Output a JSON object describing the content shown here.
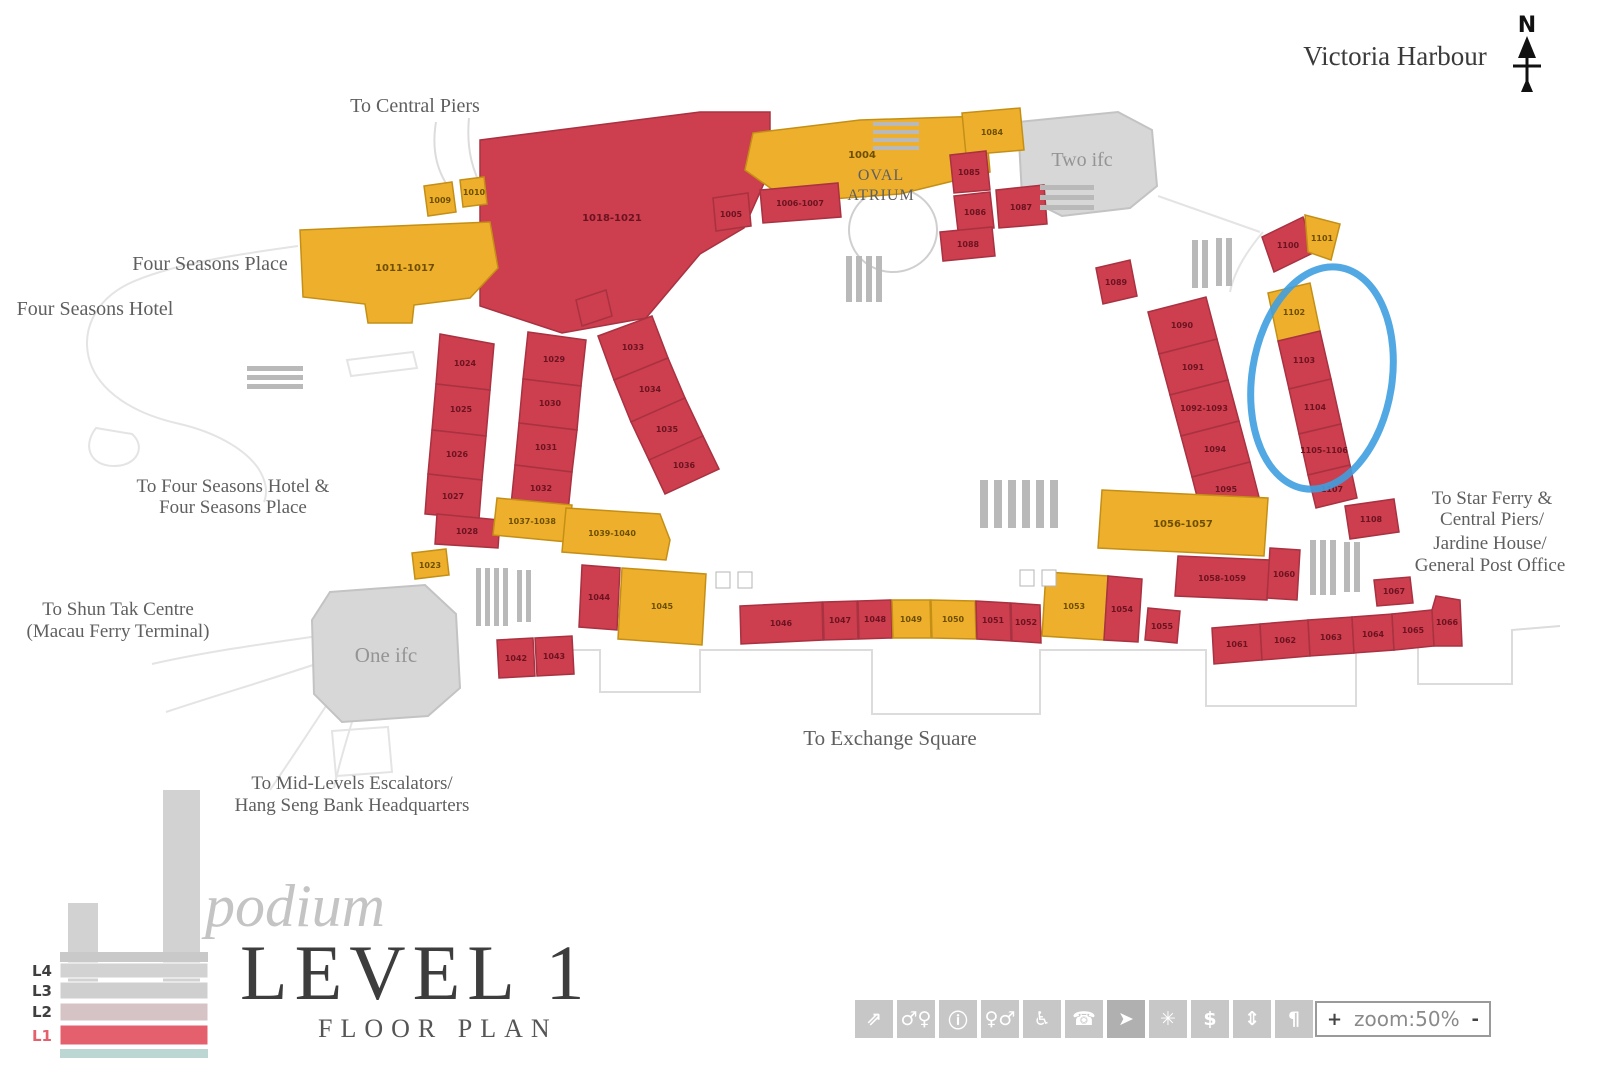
{
  "title": {
    "script": "podium",
    "main": "LEVEL 1",
    "sub": "FLOOR PLAN"
  },
  "labels": {
    "victoria_harbour": "Victoria Harbour",
    "to_central_piers": "To Central Piers",
    "four_seasons_place": "Four Seasons Place",
    "four_seasons_hotel": "Four Seasons Hotel",
    "to_four_seasons_1": "To Four Seasons Hotel &",
    "to_four_seasons_2": "Four Seasons Place",
    "to_shun_tak_1": "To Shun Tak Centre",
    "to_shun_tak_2": "(Macau Ferry Terminal)",
    "one_ifc": "One ifc",
    "two_ifc": "Two ifc",
    "oval_1": "OVAL",
    "oval_2": "ATRIUM",
    "to_exchange_square": "To Exchange Square",
    "to_mid_levels_1": "To Mid-Levels Escalators/",
    "to_mid_levels_2": "Hang Seng Bank Headquarters",
    "to_star_ferry_1": "To Star Ferry &",
    "to_star_ferry_2": "Central Piers/",
    "to_star_ferry_3": "Jardine House/",
    "to_star_ferry_4": "General Post Office",
    "compass_n": "N"
  },
  "levels": [
    {
      "label": "L4",
      "active": false
    },
    {
      "label": "L3",
      "active": false
    },
    {
      "label": "L2",
      "active": false
    },
    {
      "label": "L1",
      "active": true
    }
  ],
  "shops": {
    "tl_big": "1018-1021",
    "fsp": "1011-1017",
    "y_small1": "1009",
    "y_small2": "1010",
    "wedge": "1004",
    "under_a": "1005",
    "under_b": "1006-1007",
    "oval_y": "1084",
    "oval_r1": "1085",
    "oval_r2": "1086",
    "oval_r3": "1087",
    "oval_r4": "1088",
    "tr_red": "1100",
    "tr_yellow": "1101",
    "col_y": "1102",
    "col_r1": "1103",
    "col_r2": "1104",
    "col_r3": "1105-1106",
    "col_foot": "1107",
    "col_below": "1108",
    "rc_top": "1089",
    "rc1": "1090",
    "rc2": "1091",
    "rc3": "1092-1093",
    "rc4": "1094",
    "rc5": "1095",
    "la1": "1024",
    "la2": "1025",
    "la3": "1026",
    "la4": "1027",
    "la5": "1028",
    "lb1": "1029",
    "lb2": "1030",
    "lb3": "1031",
    "lb4": "1032",
    "arc1": "1033",
    "arc2": "1034",
    "arc3": "1035",
    "arc4": "1036",
    "ym1": "1037-1038",
    "ym2": "1039-1040",
    "ys": "1023",
    "oi_r1": "1042",
    "oi_r2": "1043",
    "ml_r": "1044",
    "ml_y": "1045",
    "br1": "1046",
    "br2": "1047",
    "br3": "1048",
    "br4": "1049",
    "br5": "1050",
    "br6": "1051",
    "br7": "1052",
    "py": "1053",
    "pr": "1054",
    "slr": "1055",
    "byr": "1056-1057",
    "rbr": "1058-1059",
    "rstack": "1060",
    "lr1": "1061",
    "lr2": "1062",
    "lr3": "1063",
    "lr4": "1064",
    "lr5": "1065",
    "lr6": "1066",
    "sar": "1067"
  },
  "toolbar": {
    "icons": [
      {
        "name": "escalator-icon",
        "glyph": "⇗"
      },
      {
        "name": "restroom-icon",
        "glyph": "♂♀"
      },
      {
        "name": "info-icon",
        "glyph": "ⓘ"
      },
      {
        "name": "washroom-icon",
        "glyph": "♀♂"
      },
      {
        "name": "accessible-icon",
        "glyph": "♿"
      },
      {
        "name": "telephone-icon",
        "glyph": "☎"
      },
      {
        "name": "direction-pointer-icon",
        "glyph": "➤"
      },
      {
        "name": "first-aid-icon",
        "glyph": "✳"
      },
      {
        "name": "atm-icon",
        "glyph": "$"
      },
      {
        "name": "elevator-icon",
        "glyph": "⇕"
      },
      {
        "name": "facilities-icon",
        "glyph": "¶"
      }
    ]
  },
  "zoom_control": {
    "plus": "+",
    "label": "zoom:50%",
    "minus": "-"
  },
  "colors": {
    "shop_red": "#cd3e4e",
    "shop_yellow": "#eeb02c",
    "building_gray": "#d7d7d7",
    "highlight_blue": "#3f9fe0",
    "level_active": "#e4606c"
  }
}
